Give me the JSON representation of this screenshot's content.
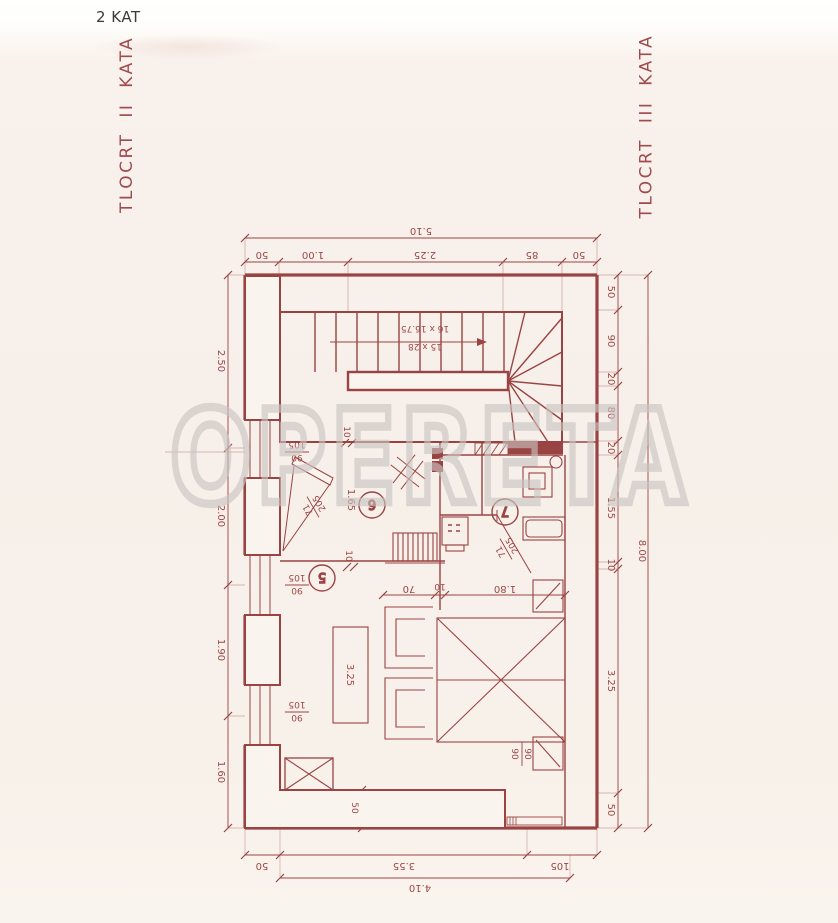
{
  "page": {
    "floor_label": "2 KAT",
    "left_title": "TLOCRT II KATA",
    "right_title": "TLOCRT III KATA",
    "watermark": "OPERETA"
  },
  "colors": {
    "wall_ink": "#9a4343",
    "dim_ink": "#ad5a55",
    "title": "#a04a4e",
    "watermark": "#c9c5c1",
    "paper": "#f7efe9"
  },
  "plan": {
    "rooms": {
      "living": "5",
      "hall": "6",
      "bath": "7"
    },
    "stair": {
      "run": "15 x 28",
      "rise": "16 x 16.75"
    },
    "doors": [
      {
        "w": "71",
        "h": "205"
      },
      {
        "w": "71",
        "h": "205"
      }
    ],
    "windows": [
      {
        "w": "90",
        "h": "105"
      },
      {
        "w": "90",
        "h": "105"
      },
      {
        "w": "90",
        "h": "105"
      },
      {
        "w": "90",
        "h": "90"
      }
    ],
    "dims": {
      "top_total": "5.10",
      "top": [
        "50",
        "1.00",
        "2.25",
        "85",
        "50"
      ],
      "bottom": [
        "50",
        "3.55",
        "105"
      ],
      "bottom_total": "4.10",
      "left": [
        "2.50",
        "2.00",
        "1.90",
        "1.60"
      ],
      "right": [
        "50",
        "90",
        "20",
        "80",
        "20",
        "1.55",
        "10",
        "3.25",
        "50"
      ],
      "right_total": "8.00",
      "inner": {
        "table": "3.25",
        "hall": "1.65",
        "bed": [
          "70",
          "10",
          "1.80"
        ],
        "thickness1": "10",
        "thickness2": "10",
        "wall": "50"
      }
    }
  }
}
